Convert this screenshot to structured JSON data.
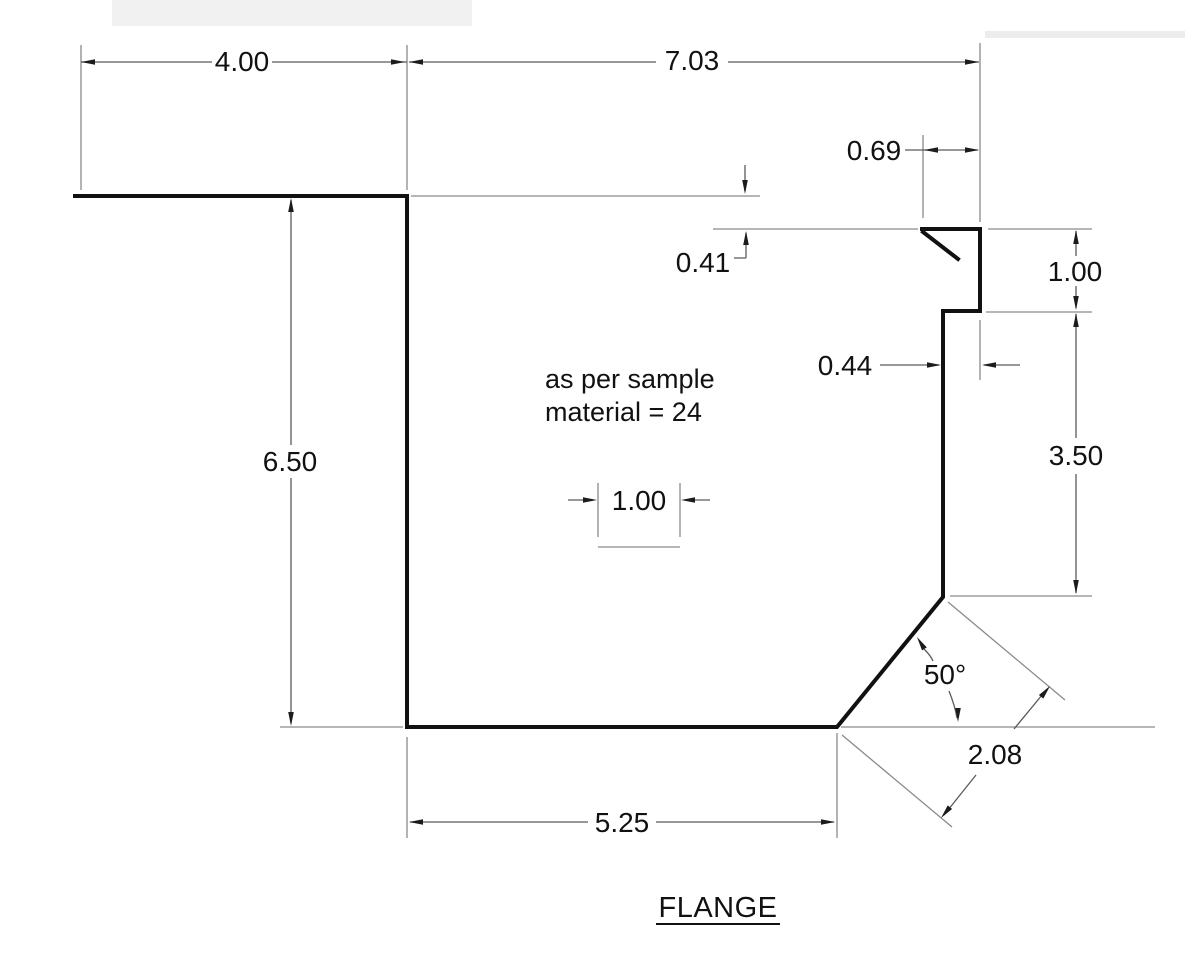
{
  "drawing": {
    "title": "FLANGE",
    "note_line1": "as per sample",
    "note_line2": "material = 24",
    "dims": {
      "top_left_width": "4.00",
      "top_right_width": "7.03",
      "hem_width": "0.69",
      "hem_drop": "0.41",
      "upper_right_height": "1.00",
      "step_offset": "0.44",
      "lower_right_height": "3.50",
      "left_height": "6.50",
      "center_flat_width": "1.00",
      "bend_angle": "50°",
      "bend_diagonal_length": "2.08",
      "bottom_width": "5.25"
    },
    "colors": {
      "profile_line": "#111111",
      "dimension_line": "#5a5a5a",
      "extension_line": "#8a8a8a",
      "background": "#ffffff"
    }
  }
}
